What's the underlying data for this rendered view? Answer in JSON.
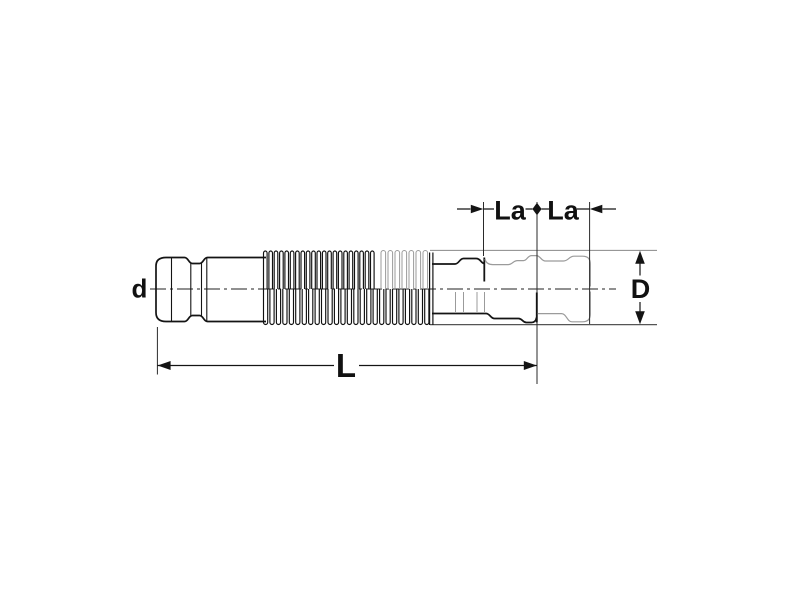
{
  "figure": {
    "description": "Dimensional line drawing of an axial expansion joint (compensator) with pressing sockets, shown in compressed, neutral and extended positions",
    "labels": {
      "d": "d",
      "D": "D",
      "L": "L",
      "La_left": "La",
      "La_right": "La"
    },
    "colors": {
      "line": "#141414",
      "phantom": "#9b9b9b",
      "envelope_top": "#888888",
      "envelope_bottom": "#555555",
      "dimension": "#141414",
      "centerline": "#222222",
      "background": "#ffffff"
    },
    "bellows": {
      "groups": [
        {
          "name": "compressed-top-crests",
          "x0": 263.5,
          "x1": 379,
          "pitch": 5.35,
          "w": 3.6,
          "yStart": 289,
          "yCap": 251,
          "r": 2.2,
          "color": "#111111",
          "sw": 1.15
        },
        {
          "name": "neutral-bottom-crests",
          "x0": 263.5,
          "x1": 430,
          "pitch": 6.45,
          "w": 4.2,
          "yStart": 289,
          "yCap": 324.5,
          "r": 2.2,
          "color": "#111111",
          "sw": 1.15
        },
        {
          "name": "extended-top-crests-phantom",
          "x0": 381,
          "x1": 431,
          "pitch": 7.0,
          "w": 4.6,
          "yStart": 289,
          "yCap": 250.5,
          "r": 2.3,
          "color": "#9b9b9b",
          "sw": 1.0
        }
      ]
    }
  }
}
